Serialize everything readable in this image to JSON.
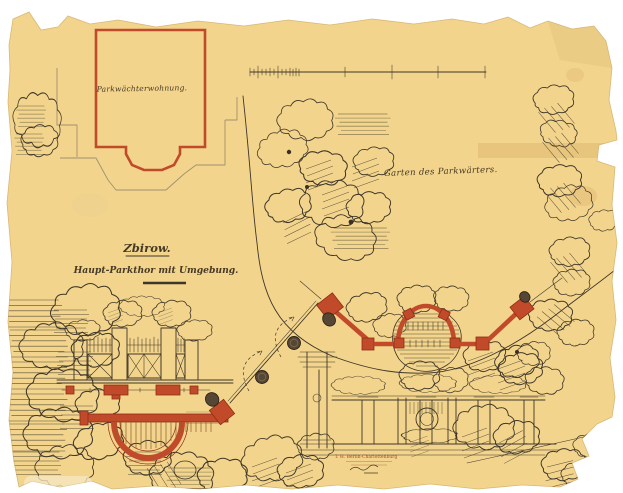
{
  "artwork": {
    "title_line1": "Zbirow.",
    "title_line2": "Haupt-Parkthor mit Umgebung.",
    "label_building": "Parkwächterwohnung.",
    "label_garden": "Garten des Parkwärters.",
    "stamp_line1": "T. H. Berlin-Charlottenburg"
  },
  "colors": {
    "background": "#ffffff",
    "paper": "#f2d48c",
    "ink": "#3e3628",
    "red_ink": "#c14a2b",
    "gray_line": "#a19072"
  }
}
